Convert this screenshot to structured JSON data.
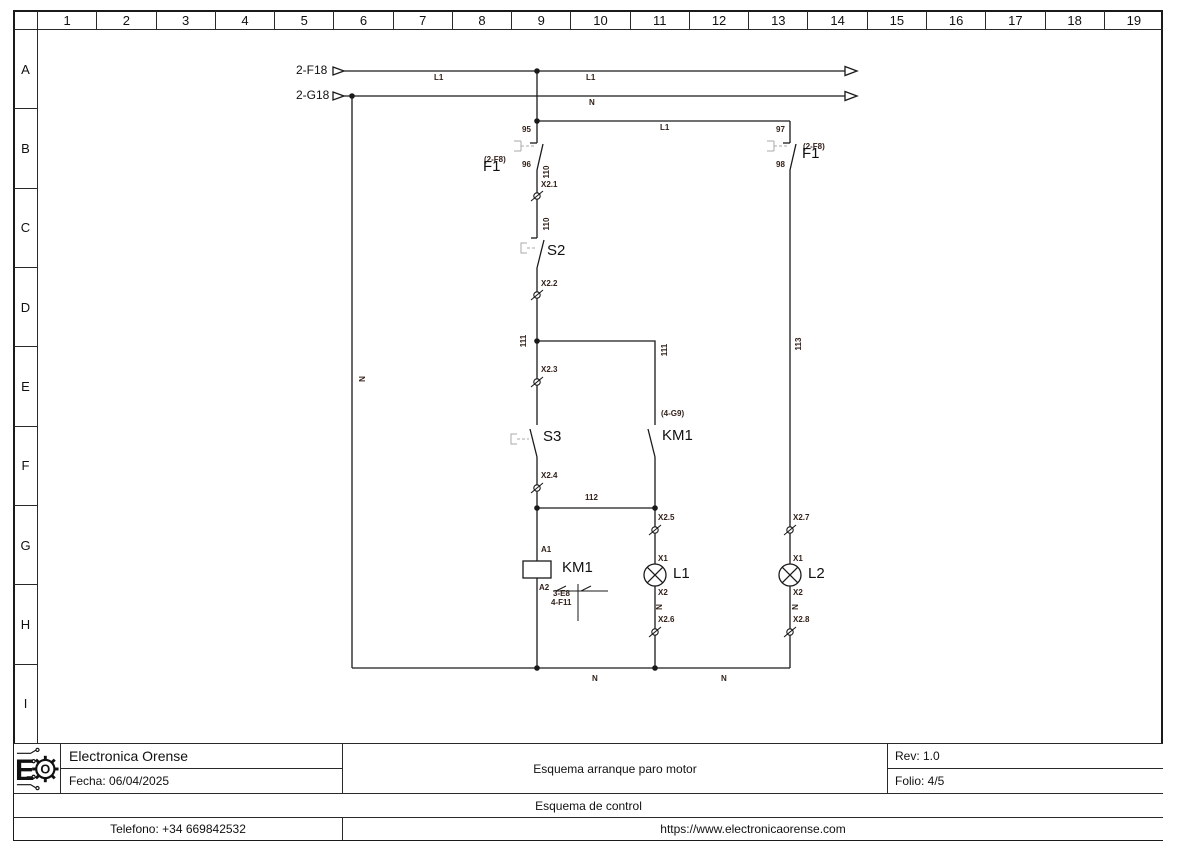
{
  "grid": {
    "columns": [
      "1",
      "2",
      "3",
      "4",
      "5",
      "6",
      "7",
      "8",
      "9",
      "10",
      "11",
      "12",
      "13",
      "14",
      "15",
      "16",
      "17",
      "18",
      "19"
    ],
    "rows": [
      "A",
      "B",
      "C",
      "D",
      "E",
      "F",
      "G",
      "H",
      "I"
    ]
  },
  "title_block": {
    "company": "Electronica Orense",
    "date": "Fecha: 06/04/2025",
    "title": "Esquema arranque paro motor",
    "rev": "Rev: 1.0",
    "folio": "Folio: 4/5",
    "subtitle": "Esquema de control",
    "phone": "Telefono: +34 669842532",
    "website": "https://www.electronicaorense.com",
    "logo_letter": "E",
    "logo_gear_letter": "O"
  },
  "schematic": {
    "line_color": "#1a1a1a",
    "label_color": "#33211a",
    "actuator_color": "#aaaaaa",
    "labels": [
      {
        "text": "2-F18",
        "x": 296,
        "y": 64,
        "cls": "md",
        "name": "source-ref-2f18"
      },
      {
        "text": "2-G18",
        "x": 296,
        "y": 89,
        "cls": "md",
        "name": "source-ref-2g18"
      },
      {
        "text": "L1",
        "x": 434,
        "y": 74,
        "cls": "sm",
        "name": "wire-label-l1"
      },
      {
        "text": "L1",
        "x": 586,
        "y": 74,
        "cls": "sm",
        "name": "wire-label-l1"
      },
      {
        "text": "N",
        "x": 589,
        "y": 99,
        "cls": "sm",
        "name": "wire-label-n"
      },
      {
        "text": "L1",
        "x": 660,
        "y": 124,
        "cls": "sm",
        "name": "wire-label-l1"
      },
      {
        "text": "N",
        "x": 363,
        "y": 379,
        "cls": "sm rot",
        "name": "wire-label-n"
      },
      {
        "text": "95",
        "x": 522,
        "y": 126,
        "cls": "sm",
        "name": "terminal-95"
      },
      {
        "text": "96",
        "x": 522,
        "y": 161,
        "cls": "sm",
        "name": "terminal-96"
      },
      {
        "text": "97",
        "x": 776,
        "y": 126,
        "cls": "sm",
        "name": "terminal-97"
      },
      {
        "text": "98",
        "x": 776,
        "y": 161,
        "cls": "sm",
        "name": "terminal-98"
      },
      {
        "text": "(2-F8)",
        "x": 484,
        "y": 156,
        "cls": "sm",
        "name": "crossref-f1-left"
      },
      {
        "text": "F1",
        "x": 483,
        "y": 159,
        "cls": "lg",
        "name": "component-f1-left"
      },
      {
        "text": "(2-F8)",
        "x": 803,
        "y": 143,
        "cls": "sm",
        "name": "crossref-f1-right"
      },
      {
        "text": "F1",
        "x": 802,
        "y": 146,
        "cls": "lg",
        "name": "component-f1-right"
      },
      {
        "text": "110",
        "x": 547,
        "y": 172,
        "cls": "sm rot",
        "name": "wire-label-110"
      },
      {
        "text": "X2.1",
        "x": 541,
        "y": 181,
        "cls": "sm",
        "name": "terminal-x2-1"
      },
      {
        "text": "110",
        "x": 547,
        "y": 224,
        "cls": "sm rot",
        "name": "wire-label-110"
      },
      {
        "text": "S2",
        "x": 547,
        "y": 243,
        "cls": "lg",
        "name": "component-s2"
      },
      {
        "text": "X2.2",
        "x": 541,
        "y": 280,
        "cls": "sm",
        "name": "terminal-x2-2"
      },
      {
        "text": "111",
        "x": 524,
        "y": 341,
        "cls": "sm rot",
        "name": "wire-label-111"
      },
      {
        "text": "111",
        "x": 665,
        "y": 350,
        "cls": "sm rot",
        "name": "wire-label-111"
      },
      {
        "text": "113",
        "x": 799,
        "y": 344,
        "cls": "sm rot",
        "name": "wire-label-113"
      },
      {
        "text": "X2.3",
        "x": 541,
        "y": 366,
        "cls": "sm",
        "name": "terminal-x2-3"
      },
      {
        "text": "(4-G9)",
        "x": 661,
        "y": 410,
        "cls": "sm",
        "name": "crossref-km1-contact"
      },
      {
        "text": "S3",
        "x": 543,
        "y": 429,
        "cls": "lg",
        "name": "component-s3"
      },
      {
        "text": "KM1",
        "x": 662,
        "y": 428,
        "cls": "lg",
        "name": "component-km1-contact"
      },
      {
        "text": "X2.4",
        "x": 541,
        "y": 472,
        "cls": "sm",
        "name": "terminal-x2-4"
      },
      {
        "text": "112",
        "x": 585,
        "y": 494,
        "cls": "sm",
        "name": "wire-label-112"
      },
      {
        "text": "X2.5",
        "x": 658,
        "y": 514,
        "cls": "sm",
        "name": "terminal-x2-5"
      },
      {
        "text": "X2.7",
        "x": 793,
        "y": 514,
        "cls": "sm",
        "name": "terminal-x2-7"
      },
      {
        "text": "A1",
        "x": 541,
        "y": 546,
        "cls": "sm",
        "name": "terminal-a1"
      },
      {
        "text": "KM1",
        "x": 562,
        "y": 560,
        "cls": "lg",
        "name": "component-km1-coil"
      },
      {
        "text": "A2",
        "x": 539,
        "y": 584,
        "cls": "sm",
        "name": "terminal-a2"
      },
      {
        "text": "3-E8",
        "x": 553,
        "y": 590,
        "cls": "sm",
        "name": "crossref-km1-3e8"
      },
      {
        "text": "4-F11",
        "x": 551,
        "y": 599,
        "cls": "sm",
        "name": "crossref-km1-4f11"
      },
      {
        "text": "X1",
        "x": 658,
        "y": 555,
        "cls": "sm",
        "name": "terminal-x1"
      },
      {
        "text": "L1",
        "x": 673,
        "y": 566,
        "cls": "lg",
        "name": "component-lamp-l1"
      },
      {
        "text": "X2",
        "x": 658,
        "y": 589,
        "cls": "sm",
        "name": "terminal-x2"
      },
      {
        "text": "N",
        "x": 660,
        "y": 607,
        "cls": "sm rot",
        "name": "wire-label-n"
      },
      {
        "text": "X2.6",
        "x": 658,
        "y": 616,
        "cls": "sm",
        "name": "terminal-x2-6"
      },
      {
        "text": "X1",
        "x": 793,
        "y": 555,
        "cls": "sm",
        "name": "terminal-x1"
      },
      {
        "text": "L2",
        "x": 808,
        "y": 566,
        "cls": "lg",
        "name": "component-lamp-l2"
      },
      {
        "text": "X2",
        "x": 793,
        "y": 589,
        "cls": "sm",
        "name": "terminal-x2"
      },
      {
        "text": "N",
        "x": 796,
        "y": 607,
        "cls": "sm rot",
        "name": "wire-label-n"
      },
      {
        "text": "X2.8",
        "x": 793,
        "y": 616,
        "cls": "sm",
        "name": "terminal-x2-8"
      },
      {
        "text": "N",
        "x": 592,
        "y": 675,
        "cls": "sm",
        "name": "wire-label-n"
      },
      {
        "text": "N",
        "x": 721,
        "y": 675,
        "cls": "sm",
        "name": "wire-label-n"
      }
    ]
  }
}
